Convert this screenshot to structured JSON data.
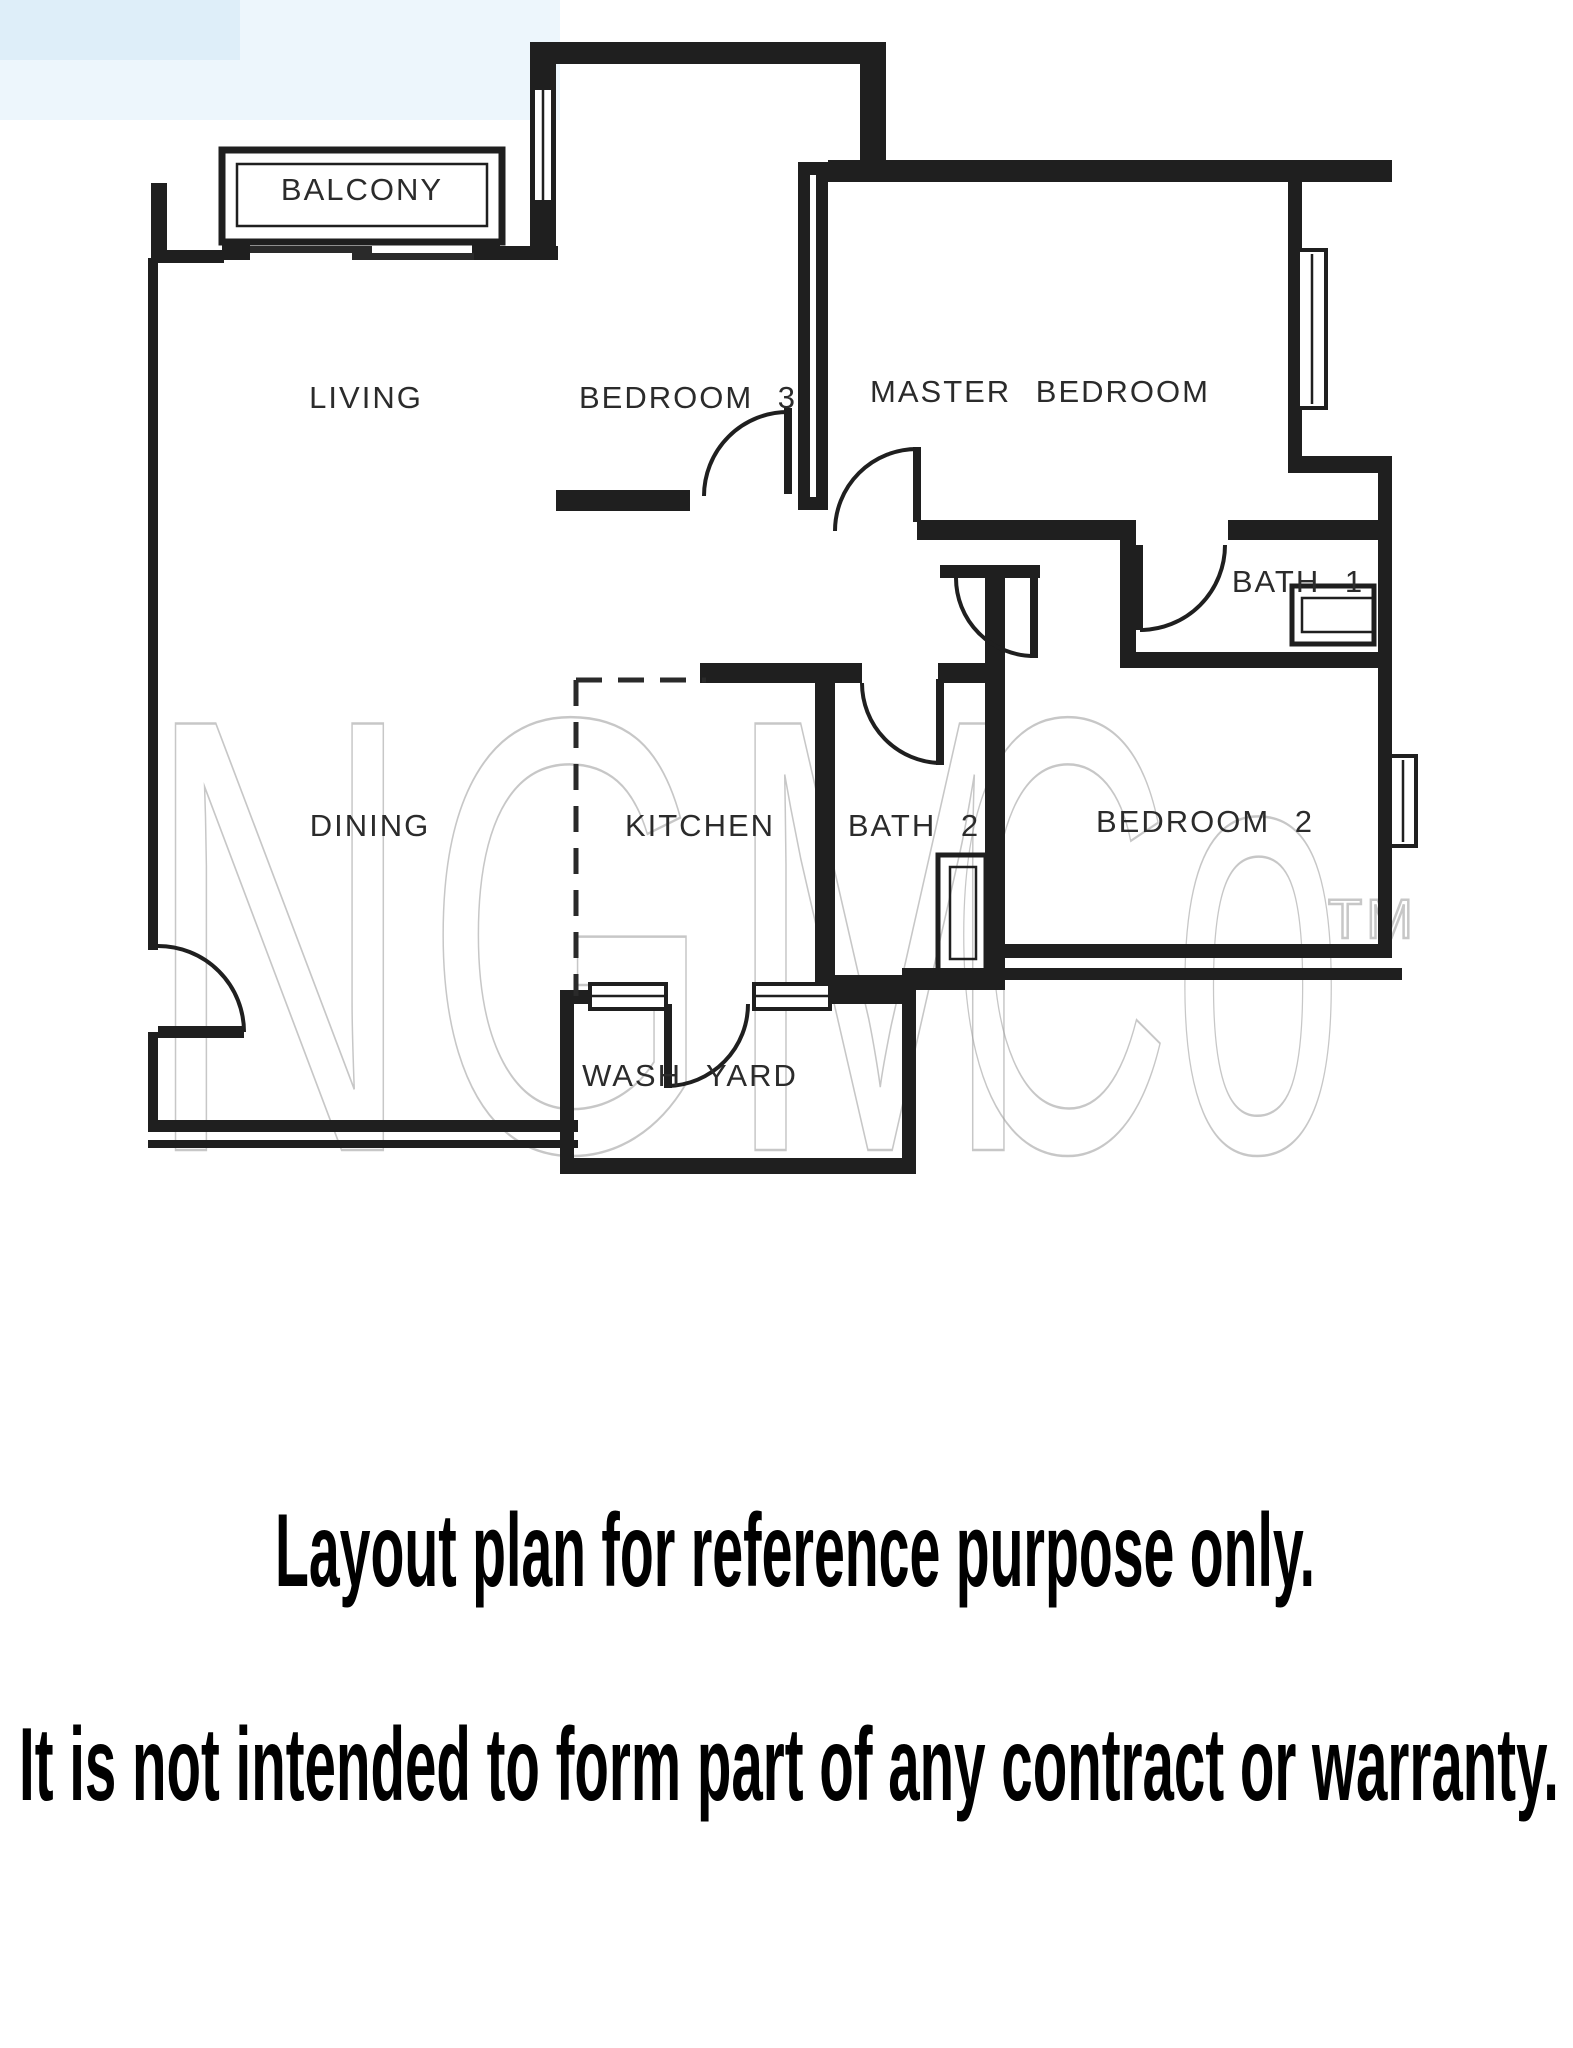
{
  "page": {
    "background": "#ffffff",
    "line_color": "#1f1f1f",
    "watermark_color": "#9a9a9a",
    "sky_tint": "#dceef9"
  },
  "floor_plan": {
    "rooms": [
      {
        "id": "balcony",
        "label": "BALCONY"
      },
      {
        "id": "living",
        "label": "LIVING"
      },
      {
        "id": "bedroom-3",
        "label": "BEDROOM 3"
      },
      {
        "id": "master-bedroom",
        "label": "MASTER BEDROOM"
      },
      {
        "id": "bath-1",
        "label": "BATH 1"
      },
      {
        "id": "dining",
        "label": "DINING"
      },
      {
        "id": "kitchen",
        "label": "KITCHEN"
      },
      {
        "id": "bath-2",
        "label": "BATH 2"
      },
      {
        "id": "bedroom-2",
        "label": "BEDROOM 2"
      },
      {
        "id": "wash-yard",
        "label": "WASH YARD"
      }
    ],
    "watermark": {
      "main": "NGM",
      "co": "Co",
      "tm": "TM"
    }
  },
  "disclaimer": {
    "line1": "Layout plan for reference purpose only.",
    "line2": "It is not intended to form part of any contract or warranty."
  }
}
